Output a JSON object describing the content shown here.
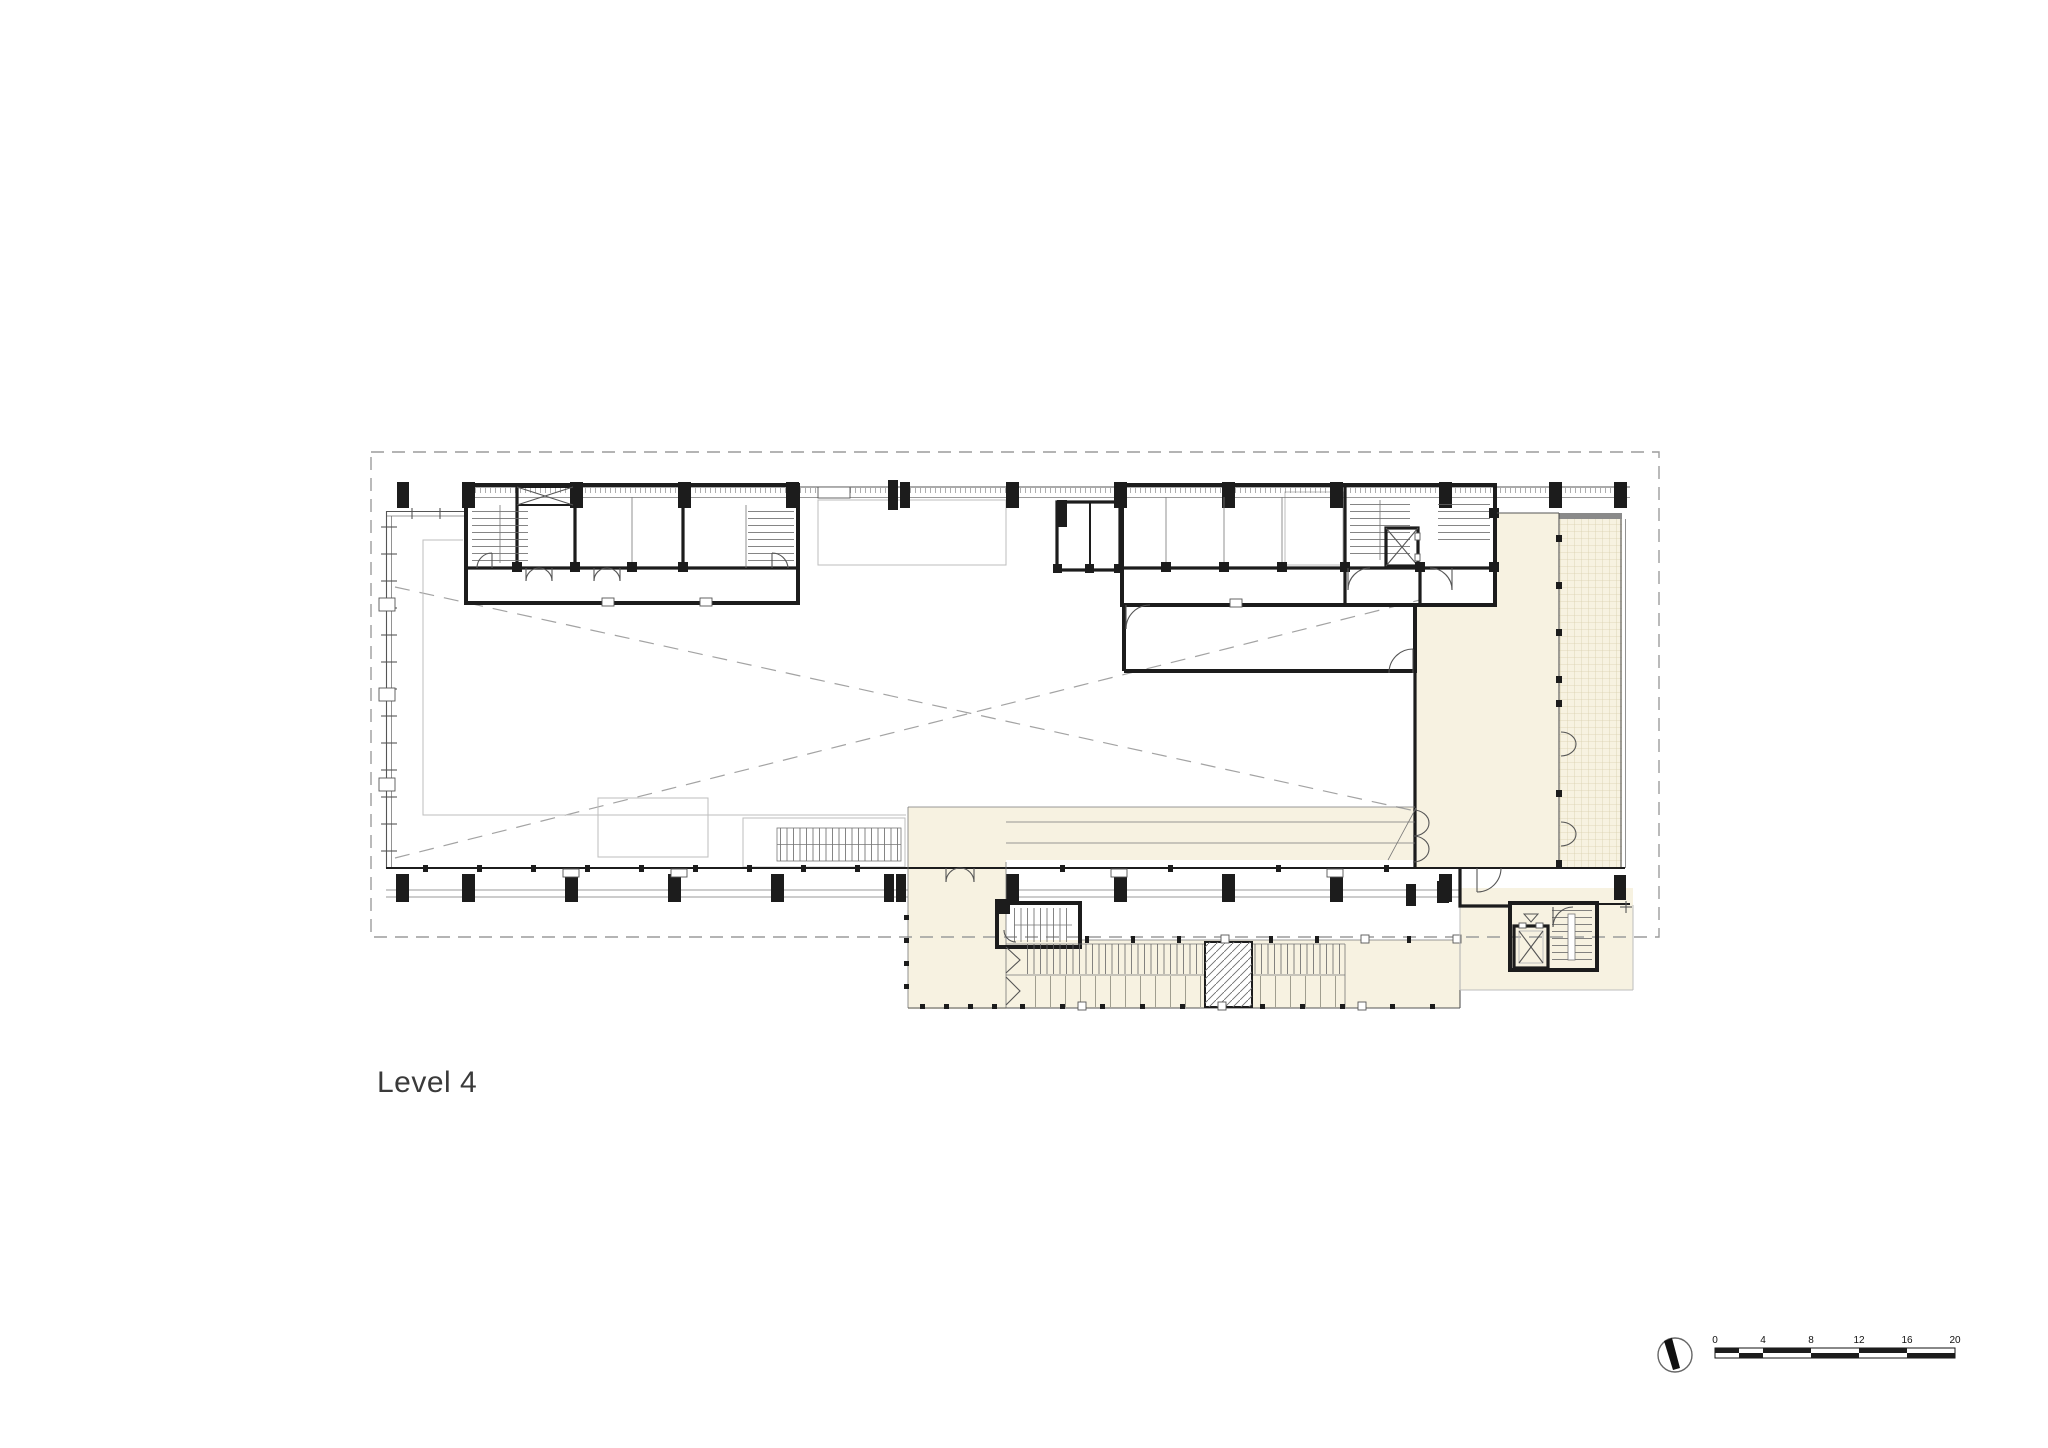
{
  "title": {
    "label": "Level 4"
  },
  "scale_bar": {
    "labels": [
      "0",
      "4",
      "8",
      "12",
      "16",
      "20"
    ]
  },
  "icons": {
    "north_arrow": "north-arrow"
  },
  "colors": {
    "beige": "#f7f2e1",
    "beigeline": "#d9d0ae",
    "wall": "#1c1c1c",
    "line": "#555555",
    "light": "#bdbdbd",
    "dash": "#9c9c9c",
    "bg": "#ffffff",
    "text": "#3a3a3a"
  }
}
